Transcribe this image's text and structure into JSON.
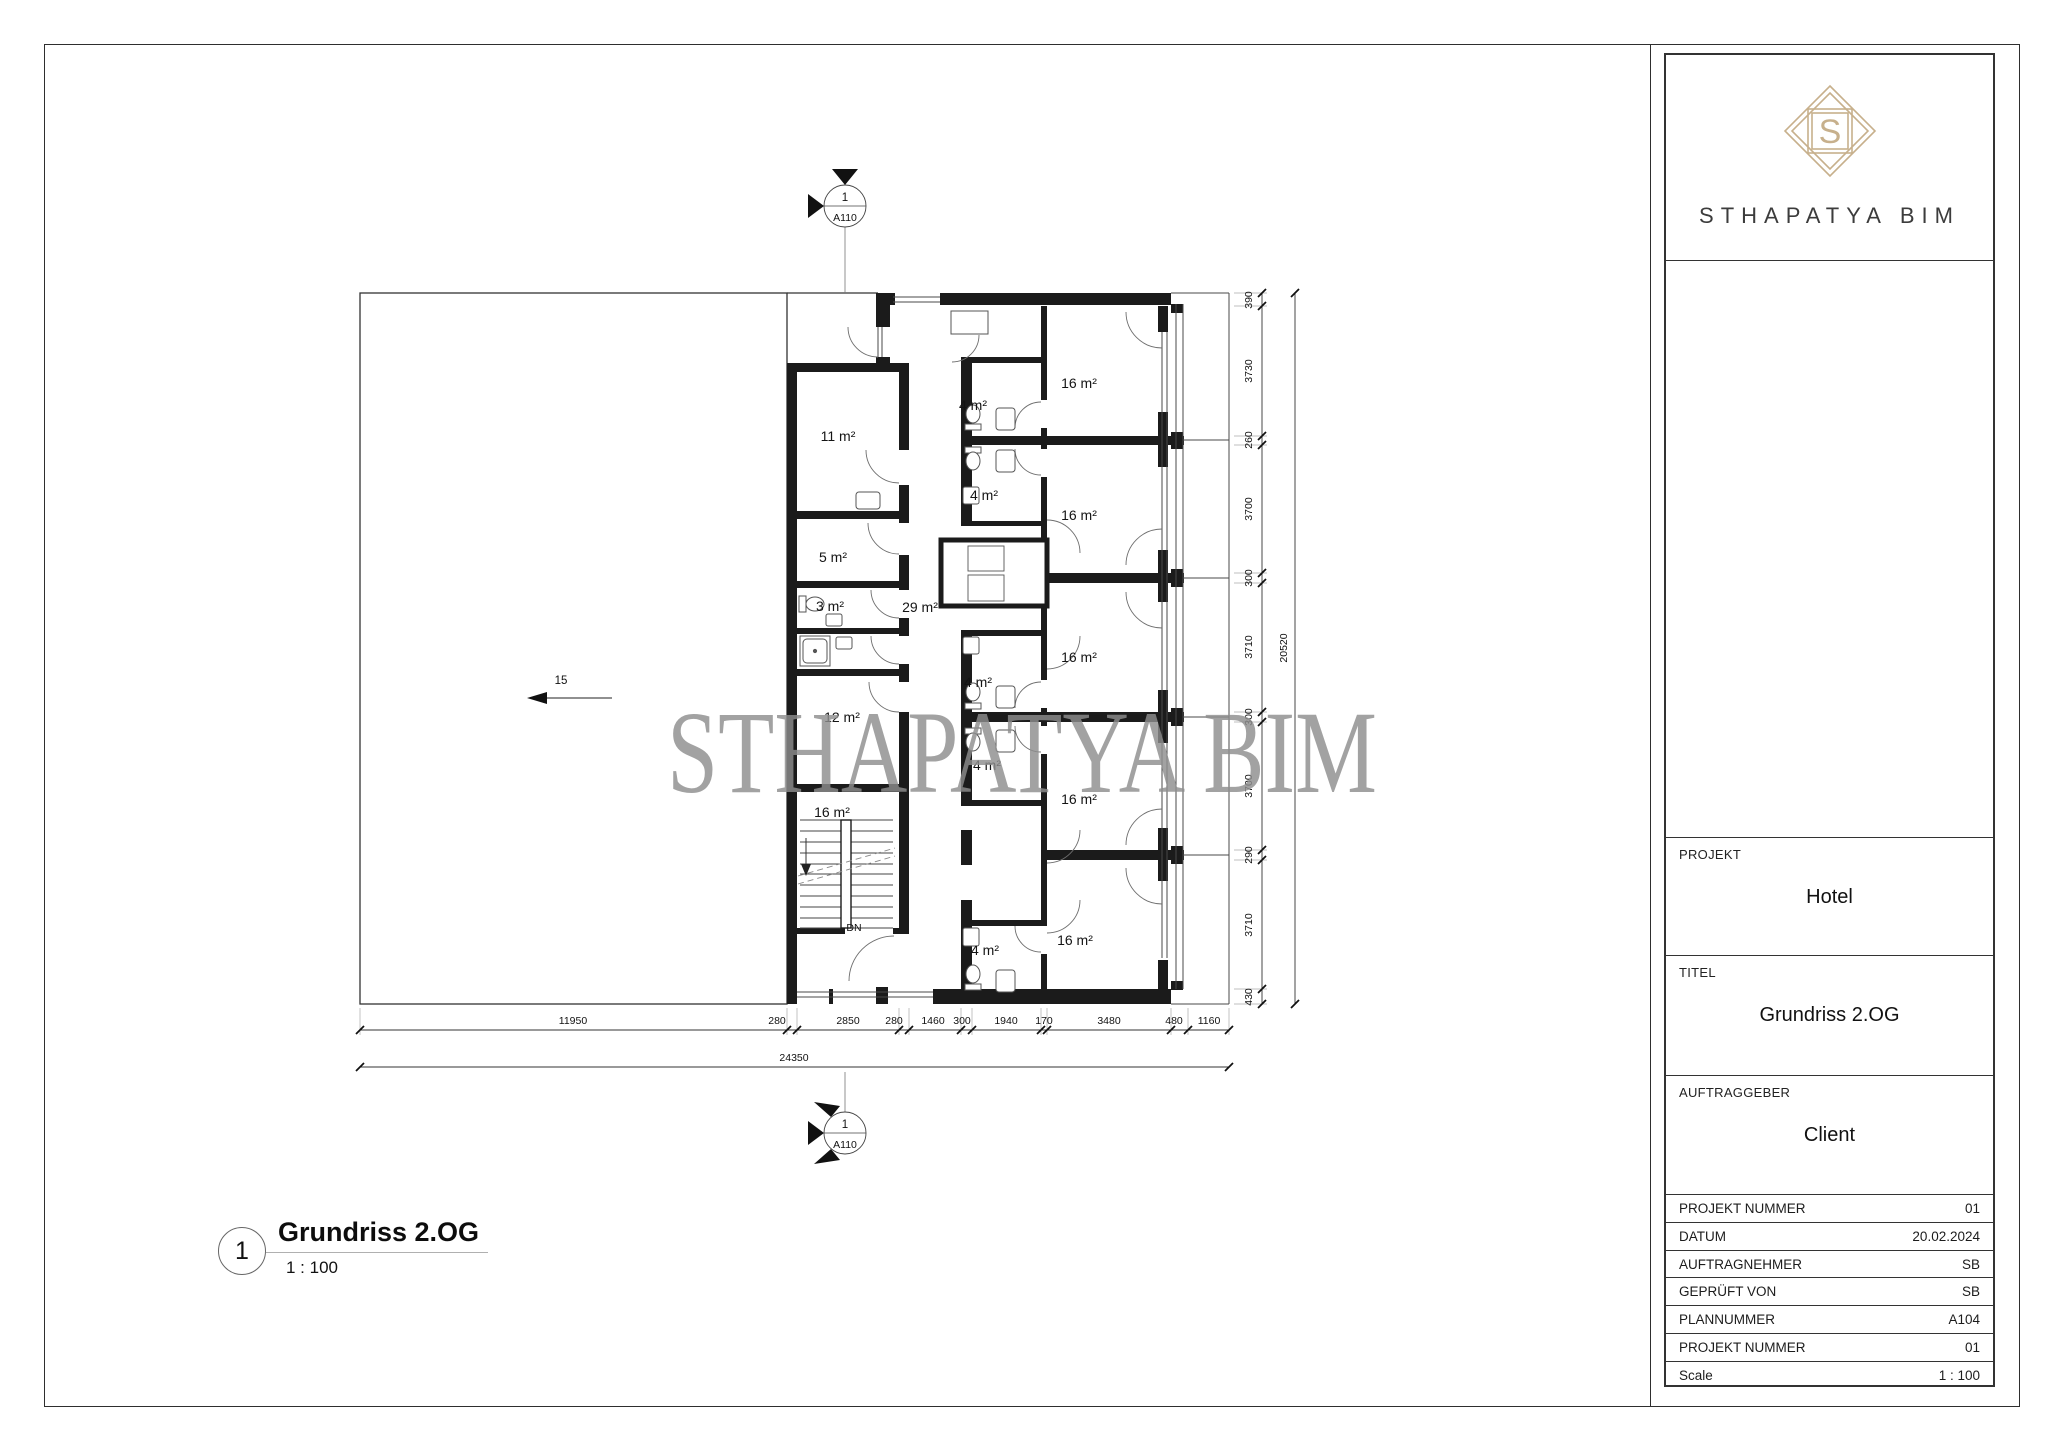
{
  "titleblock": {
    "brand": "STHAPATYA BIM",
    "logo_letter": "S",
    "projekt_label": "PROJEKT",
    "projekt_value": "Hotel",
    "titel_label": "TITEL",
    "titel_value": "Grundriss 2.OG",
    "auftraggeber_label": "AUFTRAGGEBER",
    "auftraggeber_value": "Client",
    "rows": [
      {
        "label": "PROJEKT NUMMER",
        "value": "01"
      },
      {
        "label": "DATUM",
        "value": "20.02.2024"
      },
      {
        "label": "AUFTRAGNEHMER",
        "value": "SB"
      },
      {
        "label": "GEPRÜFT VON",
        "value": "SB"
      },
      {
        "label": "PLANNUMMER",
        "value": "A104"
      },
      {
        "label": "PROJEKT NUMMER",
        "value": "01"
      },
      {
        "label": "Scale",
        "value": "1 : 100"
      }
    ]
  },
  "view_title": {
    "number": "1",
    "title": "Grundriss 2.OG",
    "scale": "1 : 100"
  },
  "plan": {
    "watermark": "STHAPATYA BIM",
    "open_area_ref": "15",
    "stair_down": "DN",
    "marker": {
      "number": "1",
      "sheet": "A110"
    },
    "room_labels": [
      "11 m²",
      "5 m²",
      "3 m²",
      "29 m²",
      "12 m²",
      "16 m²",
      "4 m²",
      "4 m²",
      "4 m²",
      "4 m²",
      "4 m²",
      "16 m²",
      "16 m²",
      "16 m²",
      "16 m²",
      "16 m²"
    ],
    "dims_bottom": [
      "11950",
      "280",
      "2850",
      "280",
      "1460",
      "300",
      "1940",
      "170",
      "3480",
      "480",
      "1160"
    ],
    "dim_bottom_total": "24350",
    "dims_right": [
      "390",
      "3730",
      "260",
      "3700",
      "300",
      "3710",
      "300",
      "3700",
      "290",
      "3710",
      "430"
    ],
    "dim_right_total": "20520"
  },
  "colors": {
    "logo_gold": "#c7b08c",
    "ink": "#1b1b1b",
    "watermark_gray": "#8d8d8d"
  }
}
